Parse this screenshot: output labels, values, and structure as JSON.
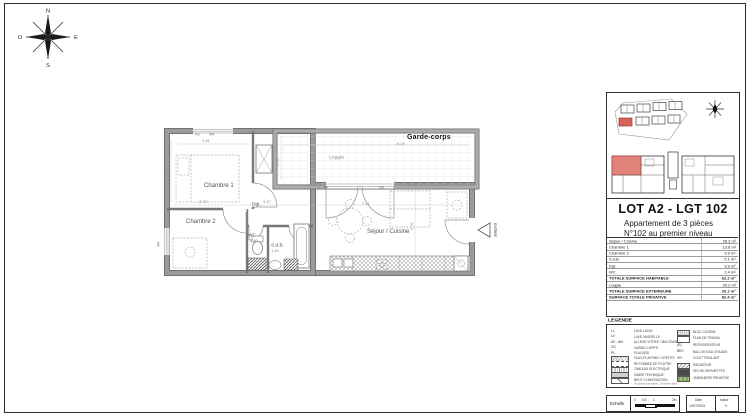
{
  "compass": {
    "n": "N",
    "e": "E",
    "s": "S",
    "o": "O"
  },
  "plan": {
    "labels": {
      "garde_corps": "Garde-corps",
      "loggia": "Loggia",
      "chambre1": "Chambre 1",
      "chambre2": "Chambre 2",
      "dgt": "Dgt.",
      "wc": "WC",
      "sdb": "S.d.B.",
      "sejour": "Séjour / Cuisine",
      "entree": "ENTREE",
      "pf": "PF",
      "vr": "VR",
      "fs": "FS",
      "vr2": "VR",
      "vr3": "VR"
    },
    "dims": {
      "d281": "2.81",
      "d360": "3.60",
      "d626": "6.26",
      "d161": "1.61",
      "d279": "2.79",
      "d347": "3.47",
      "d721": "7.21",
      "d502": "5.02",
      "d090": "0.90",
      "d140": "1.40"
    }
  },
  "sidebar": {
    "title": "LOT A2 - LGT 102",
    "subtitle1": "Appartement de 3 pièces",
    "subtitle2": "N°102 au premier niveau",
    "table": {
      "rows": [
        {
          "label": "Séjour / Cuisine",
          "value": "28.3 m²"
        },
        {
          "label": "Chambre 1",
          "value": "13.6 m²"
        },
        {
          "label": "Chambre 2",
          "value": "9.9 m²"
        },
        {
          "label": "S.d.B.",
          "value": "5.1 m²"
        },
        {
          "label": "Dgt.",
          "value": "3.9 m²"
        },
        {
          "label": "WC",
          "value": "1.4 m²"
        },
        {
          "label": "TOTALE SURFACE HABITABLE",
          "value": "62.2 m²"
        },
        {
          "label": "Loggia",
          "value": "20.2 m²"
        },
        {
          "label": "TOTALE SURFACE EXTERIEURE",
          "value": "20.2 m²"
        },
        {
          "label": "SURFACE TOTALE PRIVATIVE",
          "value": "82.4 m²"
        }
      ]
    },
    "legend": {
      "title": "LEGENDE",
      "left": [
        {
          "abbr": "LL",
          "label": "LAVE-LINGE"
        },
        {
          "abbr": "LV",
          "label": "LAVE-VAISSELLE"
        },
        {
          "abbr": "AV - AM",
          "label": "ALLEGE VITREE / MACONNEE"
        },
        {
          "abbr": "GC",
          "label": "GARDE-CORPS"
        },
        {
          "abbr": "PL",
          "label": "PLACARD"
        },
        {
          "abbr": "",
          "label": "FAUX-PLAFOND / SOFFITE"
        },
        {
          "abbr": "",
          "label": "RETOMBEE DE POUTRE"
        },
        {
          "abbr": "",
          "label": "TABLEAU ELECTRIQUE"
        },
        {
          "abbr": "",
          "label": "GAINE TECHNIQUE"
        },
        {
          "abbr": "",
          "label": "BRUT CLIMATISATION",
          "note": "(Fourreaux de gaine / Synthèse vide)"
        }
      ],
      "right": [
        {
          "abbr": "",
          "label": "BLOC CUISINE"
        },
        {
          "abbr": "",
          "label": "PLAN DE TRAVAIL"
        },
        {
          "abbr": "(R)",
          "label": "REFRIGERATEUR"
        },
        {
          "abbr": "BEC",
          "label": "BALLON EAU CHAUDE"
        },
        {
          "abbr": "VR",
          "label": "VOLET ROULANT"
        },
        {
          "abbr": "",
          "label": "RADIATEUR"
        },
        {
          "abbr": "",
          "label": "SECHE-SERVIETTES"
        },
        {
          "abbr": "",
          "label": "JARDINIERE PRIVATIVE"
        }
      ]
    },
    "footer": {
      "echelle": "Echelle",
      "ticks": [
        "0",
        "0.5",
        "1",
        "2m"
      ],
      "date_label": "Date",
      "date_value": "19/07/2024",
      "indice_label": "Indice",
      "indice_value": "0"
    }
  }
}
